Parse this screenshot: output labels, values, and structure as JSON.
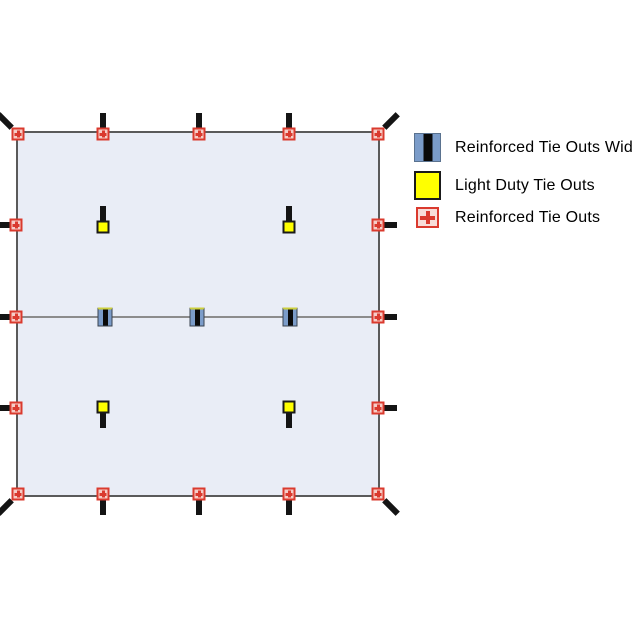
{
  "legend": {
    "items": [
      {
        "icon": "wide-tie-out-icon",
        "label": "Reinforced Tie Outs Wide"
      },
      {
        "icon": "light-duty-tie-out-icon",
        "label": "Light Duty Tie Outs"
      },
      {
        "icon": "reinforced-tie-out-icon",
        "label": "Reinforced Tie Outs"
      }
    ]
  },
  "colors": {
    "tarp_fill": "#e9edf6",
    "tarp_border": "#5a5a5a",
    "seam": "#8c8c8c",
    "reinforced_border": "#da3a2e",
    "reinforced_fill": "#f6cdc7",
    "reinforced_legend_fill": "#f8ddd9",
    "light_duty_fill": "#ffff00",
    "wide_blue": "#7b9cc9",
    "stick": "#141414"
  },
  "diagram": {
    "tarp": {
      "x": 16,
      "y": 131,
      "width": 364,
      "height": 366
    },
    "seam_y": 317,
    "markers": [
      {
        "type": "reinforced",
        "x": 18,
        "y": 134,
        "stick": "up-left"
      },
      {
        "type": "reinforced",
        "x": 103,
        "y": 134,
        "stick": "up"
      },
      {
        "type": "reinforced",
        "x": 199,
        "y": 134,
        "stick": "up"
      },
      {
        "type": "reinforced",
        "x": 289,
        "y": 134,
        "stick": "up"
      },
      {
        "type": "reinforced",
        "x": 378,
        "y": 134,
        "stick": "up-right"
      },
      {
        "type": "reinforced",
        "x": 16,
        "y": 225,
        "stick": "left"
      },
      {
        "type": "reinforced",
        "x": 16,
        "y": 317,
        "stick": "left"
      },
      {
        "type": "reinforced",
        "x": 16,
        "y": 408,
        "stick": "left"
      },
      {
        "type": "reinforced",
        "x": 378,
        "y": 225,
        "stick": "right"
      },
      {
        "type": "reinforced",
        "x": 378,
        "y": 317,
        "stick": "right"
      },
      {
        "type": "reinforced",
        "x": 378,
        "y": 408,
        "stick": "right"
      },
      {
        "type": "reinforced",
        "x": 18,
        "y": 494,
        "stick": "down-left"
      },
      {
        "type": "reinforced",
        "x": 103,
        "y": 494,
        "stick": "down"
      },
      {
        "type": "reinforced",
        "x": 199,
        "y": 494,
        "stick": "down"
      },
      {
        "type": "reinforced",
        "x": 289,
        "y": 494,
        "stick": "down"
      },
      {
        "type": "reinforced",
        "x": 378,
        "y": 494,
        "stick": "down-right"
      },
      {
        "type": "light",
        "x": 103,
        "y": 227,
        "stick": "up"
      },
      {
        "type": "light",
        "x": 289,
        "y": 227,
        "stick": "up"
      },
      {
        "type": "light",
        "x": 103,
        "y": 407,
        "stick": "down"
      },
      {
        "type": "light",
        "x": 289,
        "y": 407,
        "stick": "down"
      },
      {
        "type": "wide",
        "x": 105,
        "y": 317,
        "stick": "none"
      },
      {
        "type": "wide",
        "x": 197,
        "y": 317,
        "stick": "none"
      },
      {
        "type": "wide",
        "x": 290,
        "y": 317,
        "stick": "none"
      }
    ]
  }
}
